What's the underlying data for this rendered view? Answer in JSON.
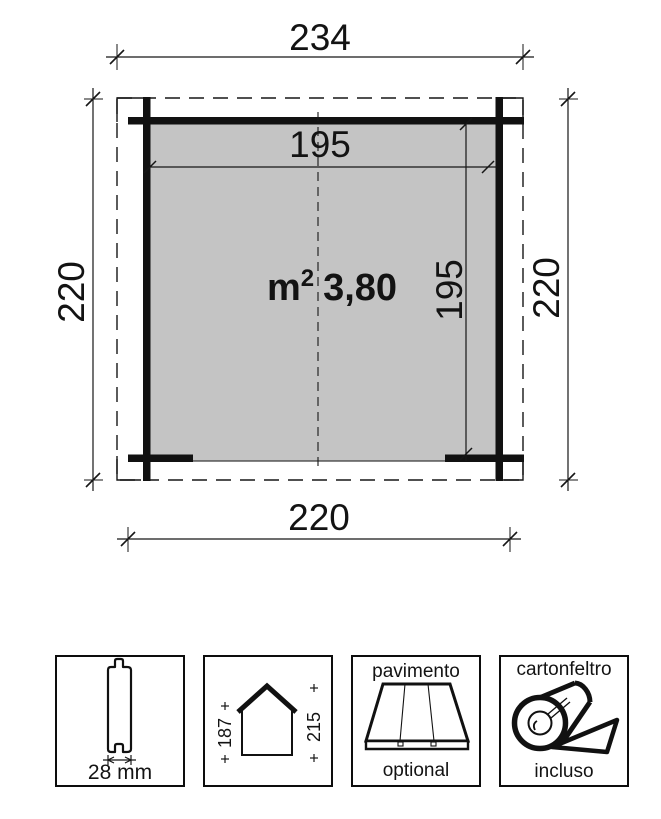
{
  "plan": {
    "dims": {
      "roof_width": "234",
      "inner_width": "195",
      "inner_depth": "195",
      "depth_left": "220",
      "depth_right": "220",
      "front_width": "220"
    },
    "area": {
      "base": "m",
      "sup": "2",
      "value": "3,80"
    },
    "colors": {
      "floor_fill": "#c4c4c4",
      "wall": "#111111",
      "line": "#161616"
    }
  },
  "boxes": {
    "plank": {
      "icon": "tongue-groove-plank",
      "dim": "28 mm"
    },
    "house": {
      "icon": "house-cross-section",
      "wall_height": "187",
      "ridge_height": "215"
    },
    "floor": {
      "icon": "floor-planks-perspective",
      "title": "pavimento",
      "note": "optional"
    },
    "felt": {
      "icon": "roofing-felt-roll",
      "title": "cartonfeltro",
      "note": "incluso"
    }
  }
}
